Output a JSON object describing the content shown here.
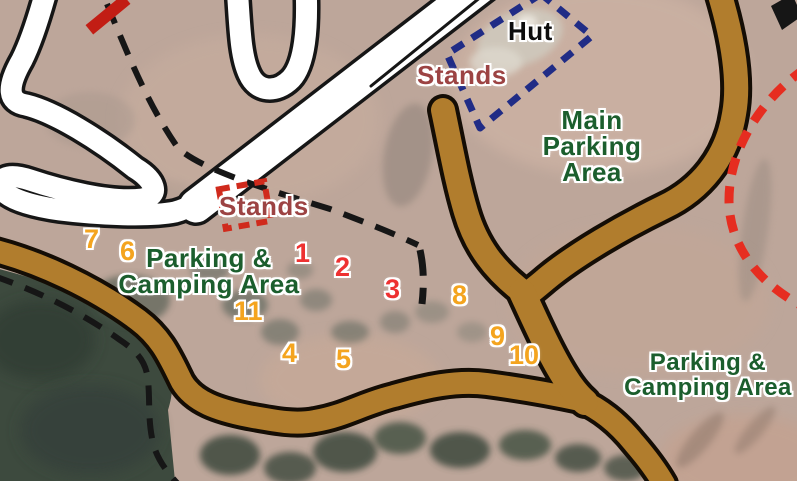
{
  "map": {
    "area_labels": {
      "hut": "Hut",
      "stands_upper": "Stands",
      "stands_track": "Stands",
      "main_parking": "Main\nParking\nArea",
      "parking_camping_west": "Parking &\nCamping Area",
      "parking_camping_east": "Parking &\nCamping Area"
    },
    "spot_markers": [
      {
        "value": "1",
        "color": "#ee3131"
      },
      {
        "value": "2",
        "color": "#ee3131"
      },
      {
        "value": "3",
        "color": "#ee3131"
      },
      {
        "value": "4",
        "color": "#f4a41f"
      },
      {
        "value": "5",
        "color": "#f4a41f"
      },
      {
        "value": "6",
        "color": "#f4a41f"
      },
      {
        "value": "7",
        "color": "#f4a41f"
      },
      {
        "value": "8",
        "color": "#f4a41f"
      },
      {
        "value": "9",
        "color": "#f4a41f"
      },
      {
        "value": "10",
        "color": "#f4a41f"
      },
      {
        "value": "11",
        "color": "#f4a41f"
      }
    ],
    "colors": {
      "road_brown": "#b17d2d",
      "track_white": "#ffffff",
      "casing_black": "#161616",
      "forest_green": "#3d4a3e",
      "ground_tan": "#bda69a",
      "label_green": "#1b5e2d",
      "label_maroon": "#9c4343",
      "label_black": "#0d0d0d",
      "marker_red": "#ee3131",
      "marker_orange": "#f4a41f",
      "boundary_blue": "#202c86",
      "boundary_red": "#e62d20",
      "start_gate_red": "#c21d14",
      "stands_marker_red": "#d02a1c"
    }
  }
}
